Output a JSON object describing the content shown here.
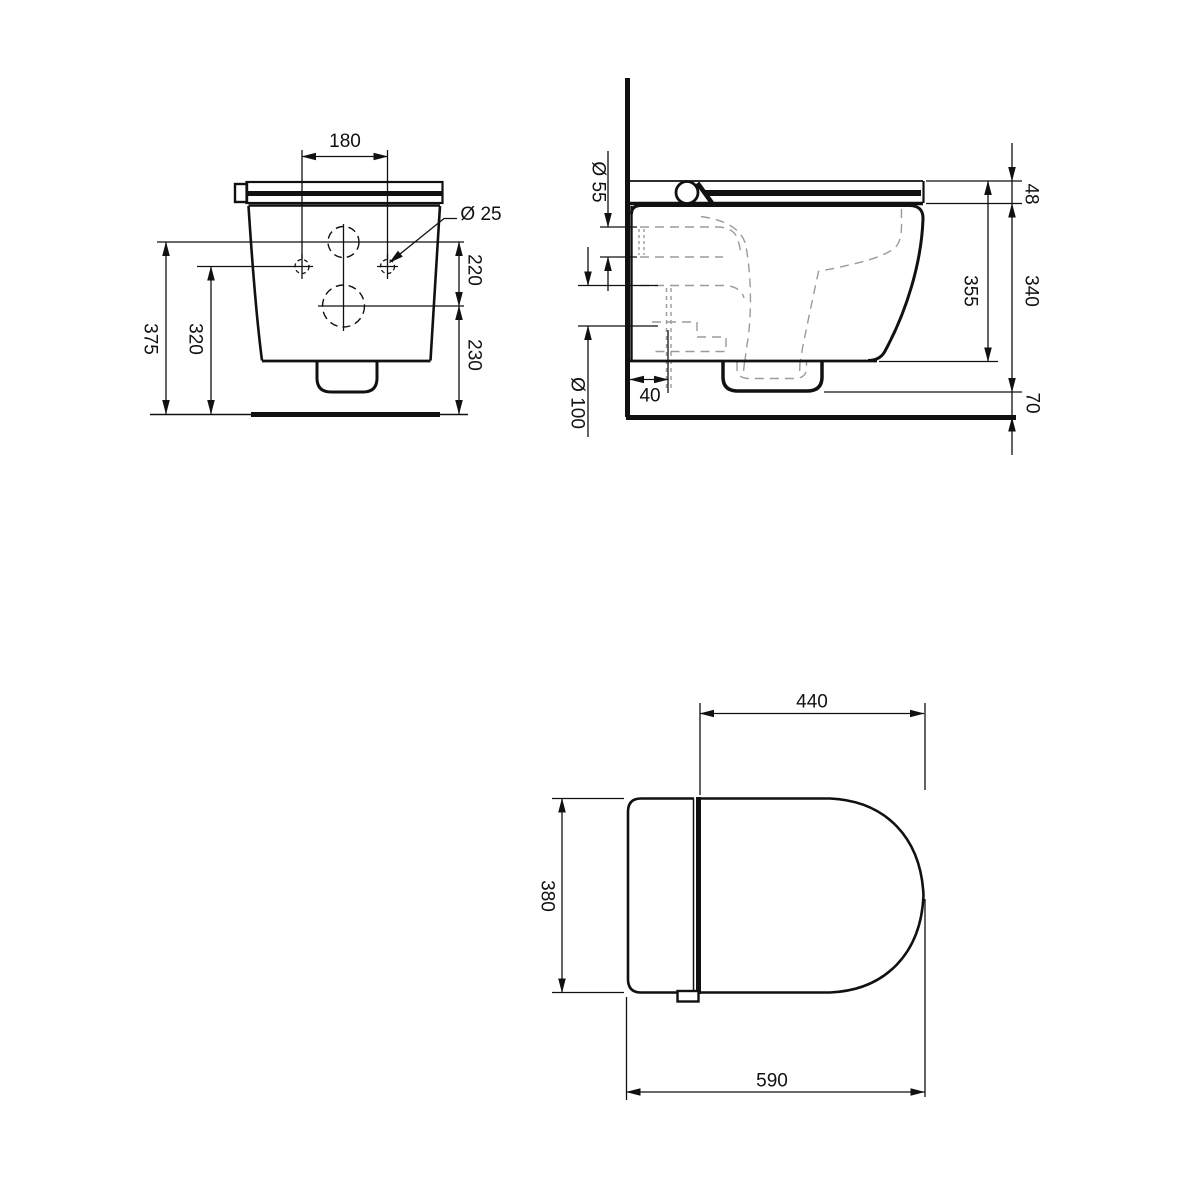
{
  "drawing": {
    "front_view": {
      "hole_spacing": "180",
      "hole_diameter": "Ø 25",
      "hole_offset_from_top": "220",
      "outlet_axis_to_floor": "230",
      "holes_to_floor": "320",
      "top_to_floor": "375"
    },
    "side_view": {
      "inlet_diameter": "Ø 55",
      "outlet_diameter": "Ø 100",
      "outlet_wall_offset": "40",
      "seat_thickness": "48",
      "body_height": "340",
      "ceramic_height": "355",
      "floor_clearance": "70"
    },
    "top_view": {
      "bowl_projection": "440",
      "bowl_width": "380",
      "total_depth": "590"
    }
  },
  "colors": {
    "line": "#111111",
    "internal_dashed": "#9b9b9b",
    "background": "#ffffff"
  }
}
